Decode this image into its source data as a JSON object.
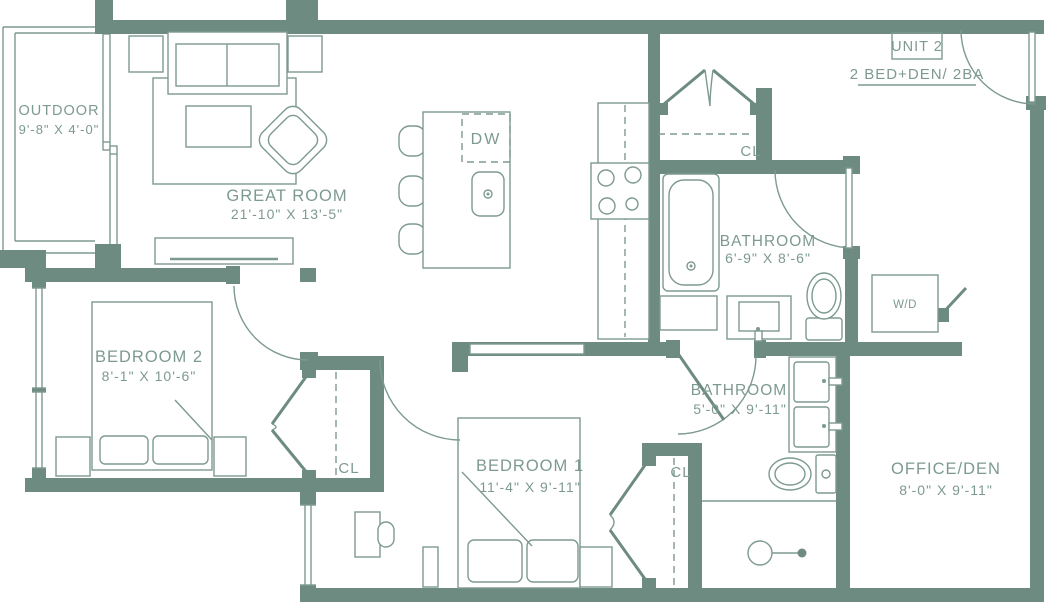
{
  "unit": {
    "name": "UNIT 2",
    "type": "2 BED+DEN/ 2BA"
  },
  "colors": {
    "wall": "#6d8b81",
    "line": "#7d9a90",
    "background": "#ffffff"
  },
  "rooms": [
    {
      "id": "outdoor",
      "name": "OUTDOOR",
      "dims": "9'-8\" X 4'-0\""
    },
    {
      "id": "great-room",
      "name": "GREAT ROOM",
      "dims": "21'-10\" X 13'-5\""
    },
    {
      "id": "bedroom-2",
      "name": "BEDROOM 2",
      "dims": "8'-1\" X 10'-6\""
    },
    {
      "id": "bathroom-1",
      "name": "BATHROOM",
      "dims": "6'-9\" X 8'-6\""
    },
    {
      "id": "bathroom-2",
      "name": "BATHROOM",
      "dims": "5'-0\" X 9'-11\""
    },
    {
      "id": "bedroom-1",
      "name": "BEDROOM 1",
      "dims": "11'-4\" X 9'-11\""
    },
    {
      "id": "office-den",
      "name": "OFFICE/DEN",
      "dims": "8'-0\" X 9'-11\""
    }
  ],
  "fixtures": {
    "closet": "CL",
    "dishwasher": "DW",
    "washer_dryer": "W/D"
  }
}
